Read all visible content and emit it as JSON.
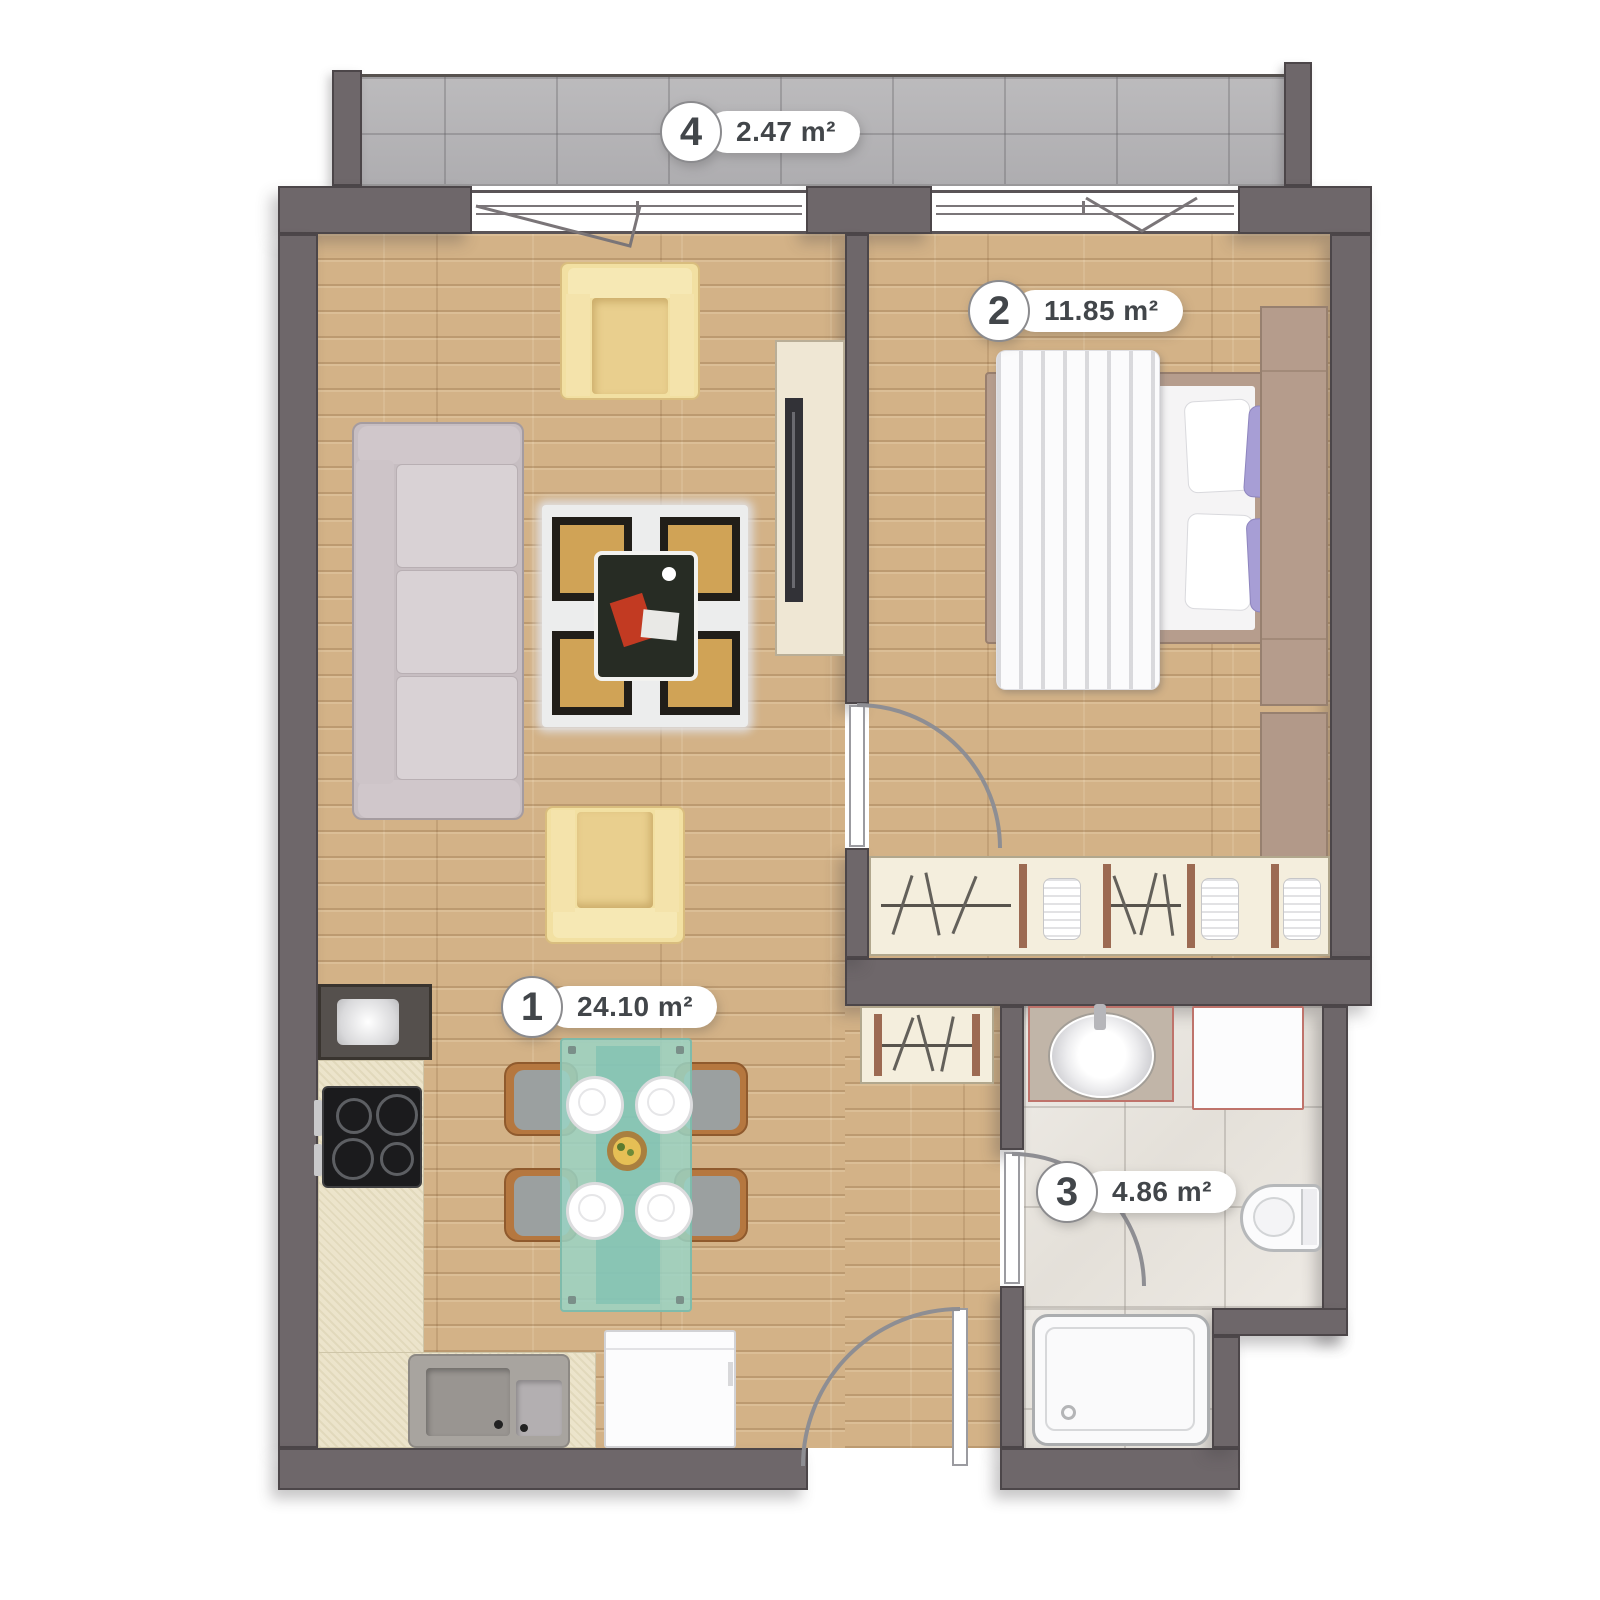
{
  "plan": {
    "rooms": [
      {
        "id": "living-kitchen",
        "number": "1",
        "area": "24.10 m²"
      },
      {
        "id": "bedroom",
        "number": "2",
        "area": "11.85 m²"
      },
      {
        "id": "bathroom",
        "number": "3",
        "area": "4.86 m²"
      },
      {
        "id": "balcony",
        "number": "4",
        "area": "2.47 m²"
      }
    ],
    "colors": {
      "wall": "#6e676a",
      "wall_outline": "#4c4649",
      "wood_floor": "#d3b287",
      "balcony_tile": "#b6b5b7",
      "bathroom_tile": "#eae6e0",
      "kitchen_counter": "#ece4cb",
      "fixture_accent": "#bf736b",
      "label_text": "#42464a",
      "door_arc": "#8e8e93",
      "rug_gold": "#d0a356",
      "dining_table_glass": "#9ad4c4",
      "pillow_purple": "#a79ed5",
      "armchair_cream": "#f2e0a2",
      "bed_frame_tan": "#b69d8d"
    }
  }
}
